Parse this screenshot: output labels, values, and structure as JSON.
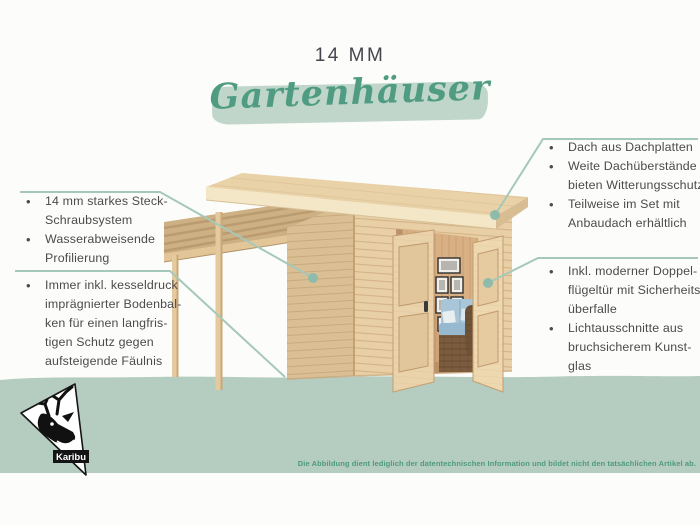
{
  "header": {
    "size_label": "14 MM",
    "title_script": "Gartenhäuser"
  },
  "features_left": {
    "group1": [
      "14 mm starkes Steck-\nSchraubsystem",
      "Wasserabweisende\nProfilierung"
    ],
    "group2": [
      "Immer inkl. kesseldruck\nimprägnierter Bodenbal-\nken für einen langfris-\ntigen Schutz gegen\naufsteigende Fäulnis"
    ]
  },
  "features_right": {
    "group1": [
      "Dach aus Dachplatten",
      "Weite Dachüberstände\nbieten Witterungsschutz",
      "Teilweise im Set mit\nAnbaudach erhältlich"
    ],
    "group2": [
      "Inkl. moderner Doppel-\nflügeltür mit Sicherheits-\nüberfalle",
      "Lichtausschnitte aus\nbruchsicherem Kunst-\nglas"
    ]
  },
  "brand": {
    "logo_label": "Karibu"
  },
  "footer": {
    "disclaimer": "Die Abbildung dient lediglich der datentechnischen Information und bildet nicht den tatsächlichen Artikel ab."
  },
  "illustration": {
    "description": "Holz-Gartenhaus mit Flachdach, seitlichem Anbaudach auf zwei Pfosten und geöffneter Doppelflügeltür mit Blick auf Sofa und Bilderwand"
  },
  "colors": {
    "band": "#b5ccc0",
    "brush": "#c0d6ca",
    "script_green": "#4f9c82",
    "heading": "#45454e",
    "body_text": "#4b4b4b",
    "connector": "#a5c8b9",
    "connector_dot": "#8ebbaa",
    "disclaimer_green": "#4e9b81",
    "wood_front": "#e8cfa5",
    "wood_side": "#d9bf93",
    "roof_cream": "#f3e7c8",
    "sofa_blue": "#a9c6d8",
    "rattan_brown": "#7b5c3e",
    "logo_black": "#141414"
  }
}
